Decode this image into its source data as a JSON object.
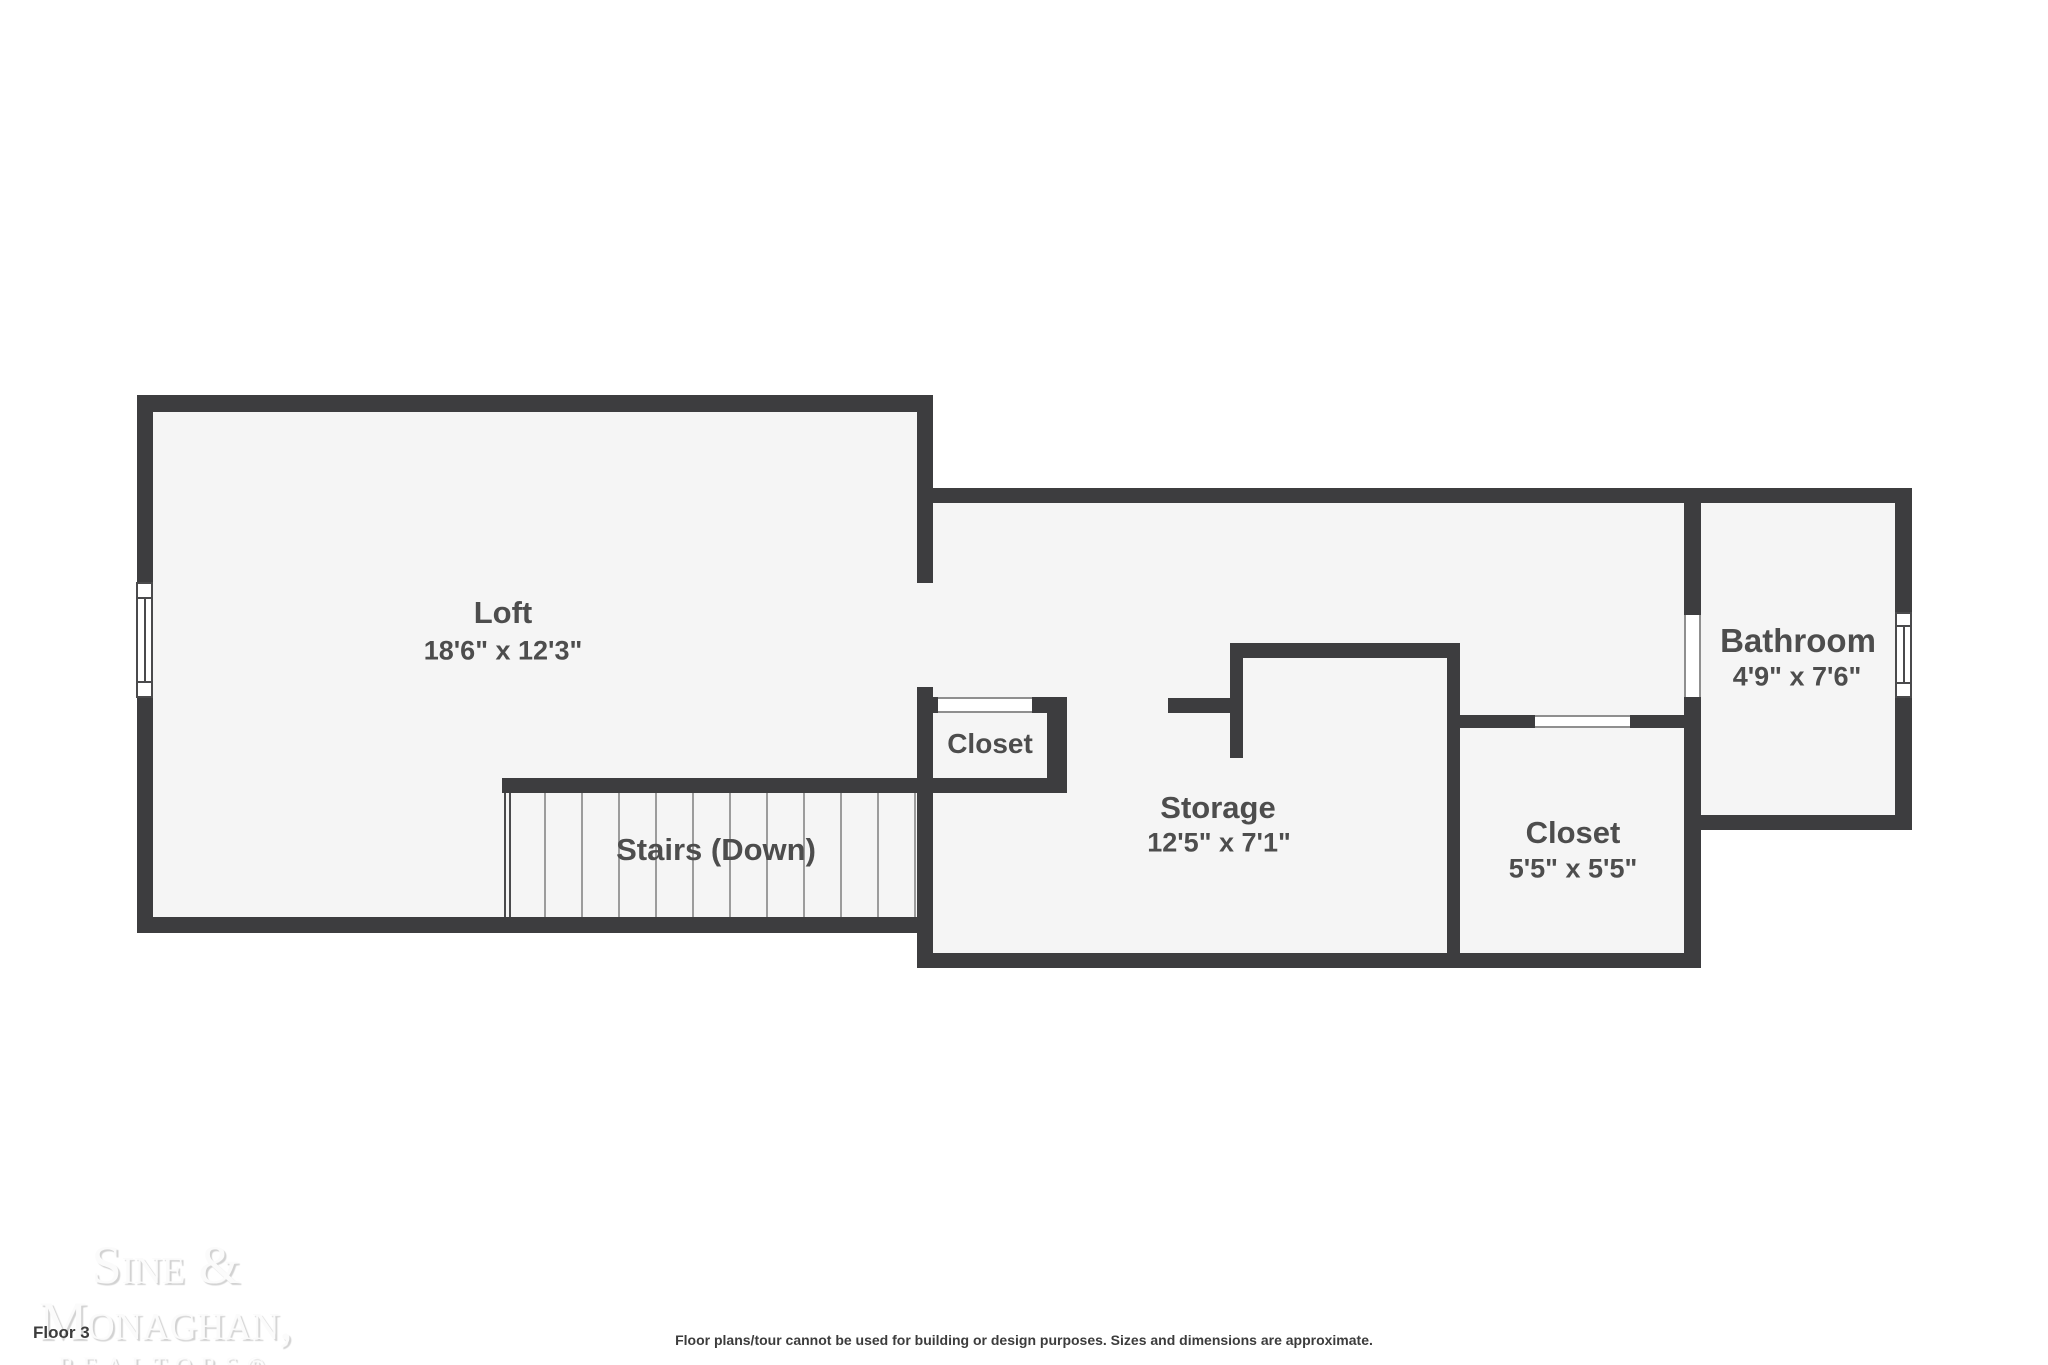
{
  "colors": {
    "wall": "#3d3d3f",
    "room_fill": "#f5f5f5",
    "label_text": "#4d4d4d",
    "background": "#ffffff"
  },
  "rooms": {
    "loft": {
      "name": "Loft",
      "dims": "18'6\" x 12'3\""
    },
    "stairs": {
      "name": "Stairs (Down)"
    },
    "closet_small": {
      "name": "Closet"
    },
    "storage": {
      "name": "Storage",
      "dims": "12'5\" x 7'1\""
    },
    "closet_right": {
      "name": "Closet",
      "dims": "5'5\" x 5'5\""
    },
    "bathroom": {
      "name": "Bathroom",
      "dims": "4'9\" x 7'6\""
    }
  },
  "branding": {
    "line1": "Sine &",
    "line2": "Monaghan,",
    "line3": "REALTORS®"
  },
  "footer": {
    "floor_label": "Floor 3",
    "disclaimer": "Floor plans/tour cannot be used for building or design purposes. Sizes and dimensions are approximate."
  }
}
